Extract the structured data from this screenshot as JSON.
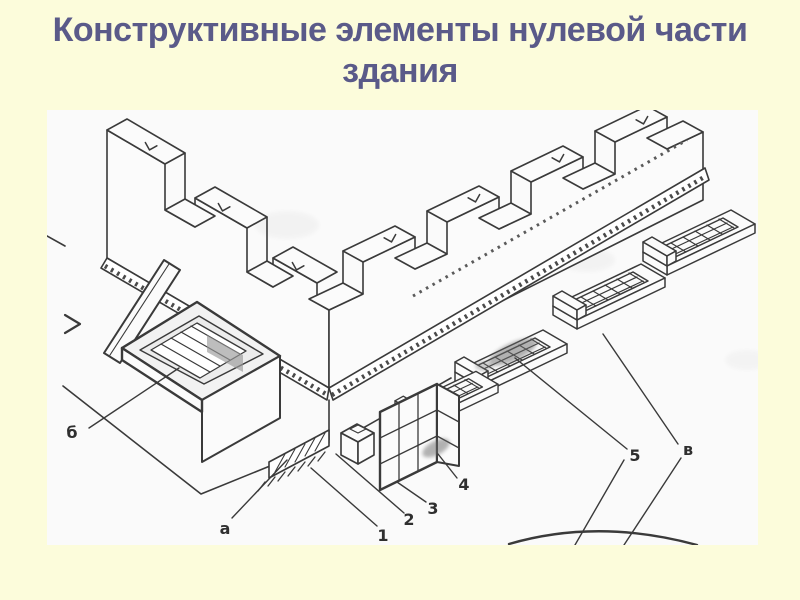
{
  "slide": {
    "background_color": "#FCFCDB",
    "title": "Конструктивные элементы нулевой части здания",
    "title_lines": [
      "Конструктивные элементы нулевой части",
      "здания"
    ],
    "title_color": "#5A5A89"
  },
  "figure": {
    "panel_color": "#FAFAFA",
    "line_color": "#3A3A3A",
    "labels": {
      "a": "а",
      "b": "б",
      "v": "в",
      "n1": "1",
      "n2": "2",
      "n3": "3",
      "n4": "4",
      "n5": "5"
    }
  }
}
